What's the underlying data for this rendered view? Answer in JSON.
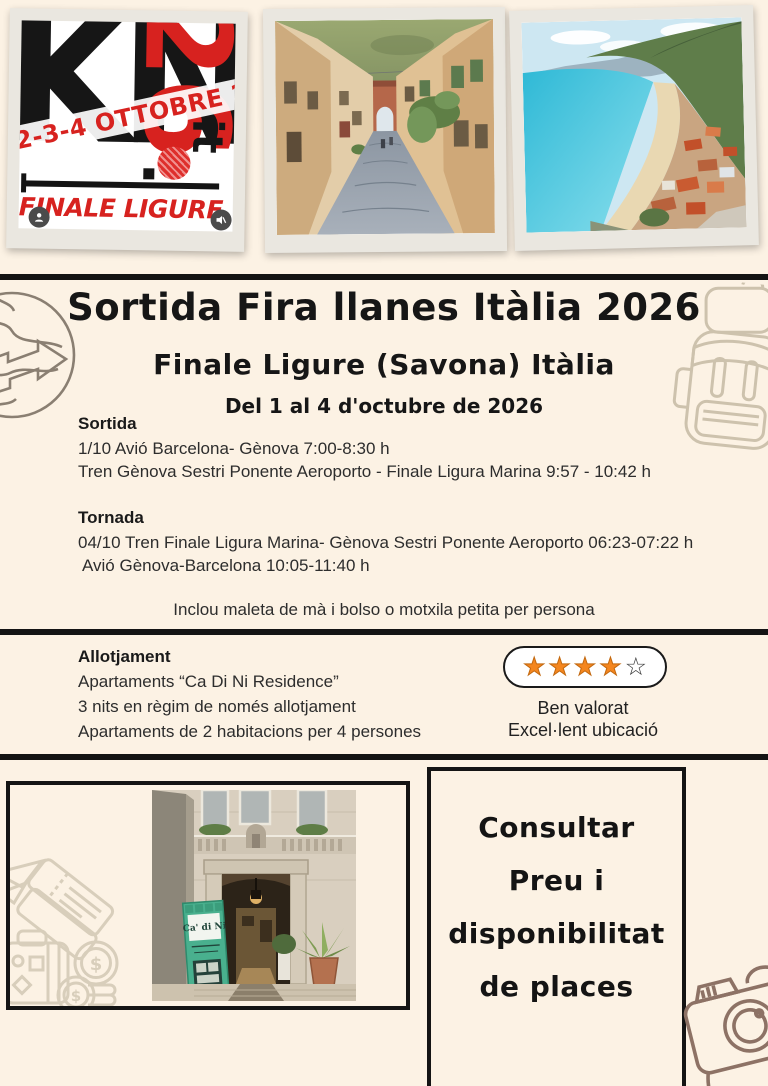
{
  "logo_card": {
    "kn": "KN",
    "it": "it",
    "num": "26",
    "banner": "2-3-4 OTTOBRE 2026",
    "location": "FINALE LIGURE (SV)"
  },
  "title": {
    "line1": "Sortida Fira llanes Itàlia 2026",
    "line2": "Finale Ligure (Savona) Itàlia",
    "line3": "Del 1 al 4 d'octubre de 2026"
  },
  "sortida": {
    "heading": "Sortida",
    "lines": [
      "1/10 Avió Barcelona- Gènova 7:00-8:30 h",
      "Tren Gènova Sestri Ponente Aeroporto - Finale Ligura Marina 9:57 - 10:42 h"
    ]
  },
  "tornada": {
    "heading": "Tornada",
    "lines": [
      "04/10 Tren Finale Ligura Marina- Gènova Sestri Ponente Aeroporto 06:23-07:22 h",
      "Avió Gènova-Barcelona 10:05-11:40  h"
    ]
  },
  "note": "Inclou maleta de mà i bolso o motxila petita per persona",
  "allotjament": {
    "heading": "Allotjament",
    "lines": [
      "Apartaments “Ca Di Ni Residence”",
      "3 nits en règim de només allotjament",
      "Apartaments de 2 habitacions per 4 persones"
    ],
    "rating": {
      "filled": 4,
      "total": 5,
      "caption1": "Ben valorat",
      "caption2": "Excel·lent ubicació"
    }
  },
  "hotel_photo": {
    "sign": "Ca' di Ni"
  },
  "cta": {
    "lines": [
      "Consultar",
      "Preu i",
      "disponibilitat",
      "de places"
    ]
  },
  "icons": {
    "star_filled": "★",
    "star_empty": "☆",
    "dollar": "$"
  },
  "colors": {
    "background": "#fcf2e4",
    "accent_red": "#d7221f",
    "star_orange": "#f4861f",
    "ink": "#141414",
    "doodle_light": "#d8cebb",
    "doodle_mid": "#cdc2ad",
    "doodle_dark": "#8d7265"
  }
}
